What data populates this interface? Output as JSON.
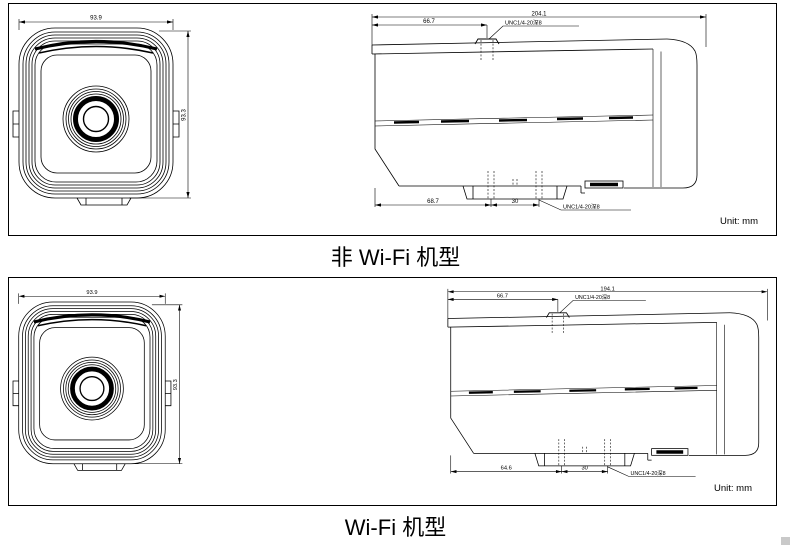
{
  "document": {
    "background": "#ffffff",
    "line_color": "#000000",
    "captions": {
      "non_wifi": "非 Wi-Fi 机型",
      "wifi": "Wi-Fi 机型"
    }
  },
  "non_wifi": {
    "unit_label": "Unit: mm",
    "front_view": {
      "width_dim": "93.9",
      "height_dim": "93.3"
    },
    "side_view": {
      "overall_length_dim": "204.1",
      "thread_offset_dim": "66.7",
      "top_thread_label": "UNC1/4-20深8",
      "base_offset_dim": "68.7",
      "hole_spacing_dim": "30",
      "bottom_thread_label": "UNC1/4-20深8"
    }
  },
  "wifi": {
    "unit_label": "Unit: mm",
    "front_view": {
      "width_dim": "93.9",
      "height_dim": "93.3"
    },
    "side_view": {
      "overall_length_dim": "194.1",
      "thread_offset_dim": "66.7",
      "top_thread_label": "UNC1/4-20深8",
      "base_offset_dim": "64.6",
      "hole_spacing_dim": "30",
      "bottom_thread_label": "UNC1/4-20深8"
    }
  }
}
